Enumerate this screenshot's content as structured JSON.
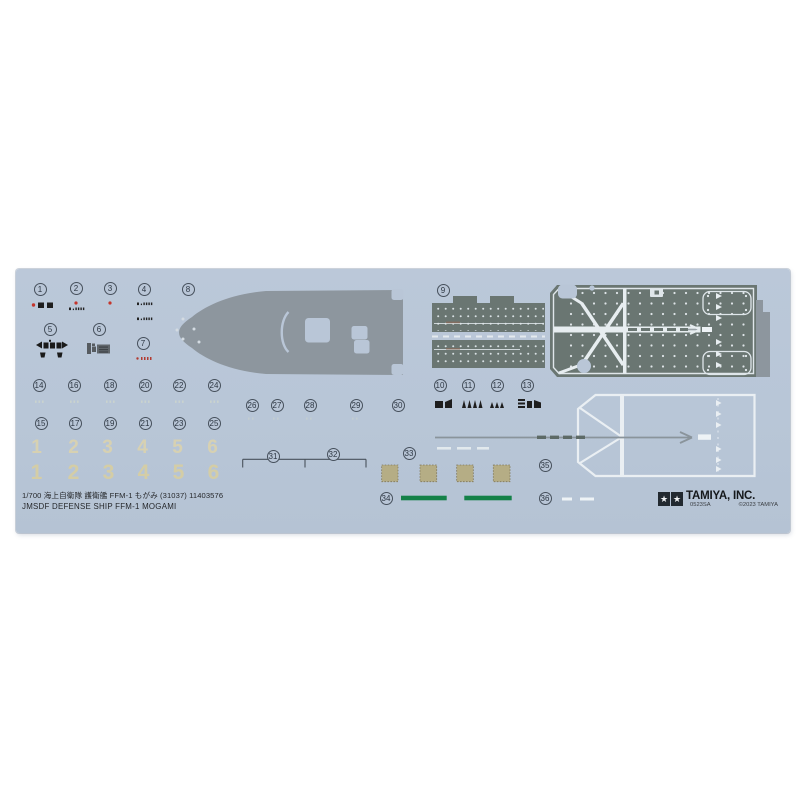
{
  "page": {
    "background": "#ffffff"
  },
  "sheet": {
    "description": "Tamiya 1/700 waterslide decal sheet",
    "background_color": "#b9c6d7",
    "footer": {
      "line1": "1/700 海上自衛隊 護衛艦 FFM-1 もがみ (31037) 11403576",
      "line2": "JMSDF DEFENSE SHIP FFM-1 MOGAMI"
    },
    "brand": {
      "name": "TAMIYA, INC.",
      "code": "0523SA",
      "copyright": "©2023 TAMIYA",
      "star_icon": "★"
    },
    "markers": [
      {
        "n": "1",
        "x": 24,
        "y": 20
      },
      {
        "n": "2",
        "x": 60,
        "y": 19
      },
      {
        "n": "3",
        "x": 94,
        "y": 19
      },
      {
        "n": "4",
        "x": 128,
        "y": 20
      },
      {
        "n": "5",
        "x": 34,
        "y": 60
      },
      {
        "n": "6",
        "x": 83,
        "y": 60
      },
      {
        "n": "7",
        "x": 127,
        "y": 74
      },
      {
        "n": "8",
        "x": 172,
        "y": 20
      },
      {
        "n": "9",
        "x": 427,
        "y": 21
      },
      {
        "n": "10",
        "x": 424,
        "y": 116
      },
      {
        "n": "11",
        "x": 452,
        "y": 116
      },
      {
        "n": "12",
        "x": 481,
        "y": 116
      },
      {
        "n": "13",
        "x": 511,
        "y": 116
      },
      {
        "n": "14",
        "x": 23,
        "y": 116
      },
      {
        "n": "15",
        "x": 25,
        "y": 154
      },
      {
        "n": "16",
        "x": 58,
        "y": 116
      },
      {
        "n": "17",
        "x": 59,
        "y": 154
      },
      {
        "n": "18",
        "x": 94,
        "y": 116
      },
      {
        "n": "19",
        "x": 94,
        "y": 154
      },
      {
        "n": "20",
        "x": 129,
        "y": 116
      },
      {
        "n": "21",
        "x": 129,
        "y": 154
      },
      {
        "n": "22",
        "x": 163,
        "y": 116
      },
      {
        "n": "23",
        "x": 163,
        "y": 154
      },
      {
        "n": "24",
        "x": 198,
        "y": 116
      },
      {
        "n": "25",
        "x": 198,
        "y": 154
      },
      {
        "n": "26",
        "x": 236,
        "y": 136
      },
      {
        "n": "27",
        "x": 261,
        "y": 136
      },
      {
        "n": "28",
        "x": 294,
        "y": 136
      },
      {
        "n": "29",
        "x": 340,
        "y": 136
      },
      {
        "n": "30",
        "x": 382,
        "y": 136
      },
      {
        "n": "31",
        "x": 257,
        "y": 187
      },
      {
        "n": "32",
        "x": 317,
        "y": 185
      },
      {
        "n": "33",
        "x": 393,
        "y": 184
      },
      {
        "n": "34",
        "x": 370,
        "y": 229
      },
      {
        "n": "35",
        "x": 529,
        "y": 196
      },
      {
        "n": "36",
        "x": 529,
        "y": 229
      }
    ],
    "draft_rows": [
      {
        "cls": "r1",
        "y": 168,
        "x_centers": [
          21,
          58,
          92,
          127,
          162,
          197
        ],
        "digits": [
          "1",
          "2",
          "3",
          "4",
          "5",
          "6"
        ]
      },
      {
        "cls": "r2",
        "y": 192,
        "x_centers": [
          21,
          58,
          93,
          128,
          163,
          198
        ],
        "digits": [
          "1",
          "2",
          "3",
          "4",
          "5",
          "6"
        ]
      }
    ],
    "colors": {
      "deck_gray": "#8d969e",
      "deck_dark_gray_green": "#6a7672",
      "marking_white": "#e7edf0",
      "khaki_square": "#b5ad85",
      "green_bar": "#148148",
      "red_dot": "#c4352c",
      "black_decal": "#1e1e1e",
      "draft_number_cream": "#d9d3b0"
    }
  }
}
